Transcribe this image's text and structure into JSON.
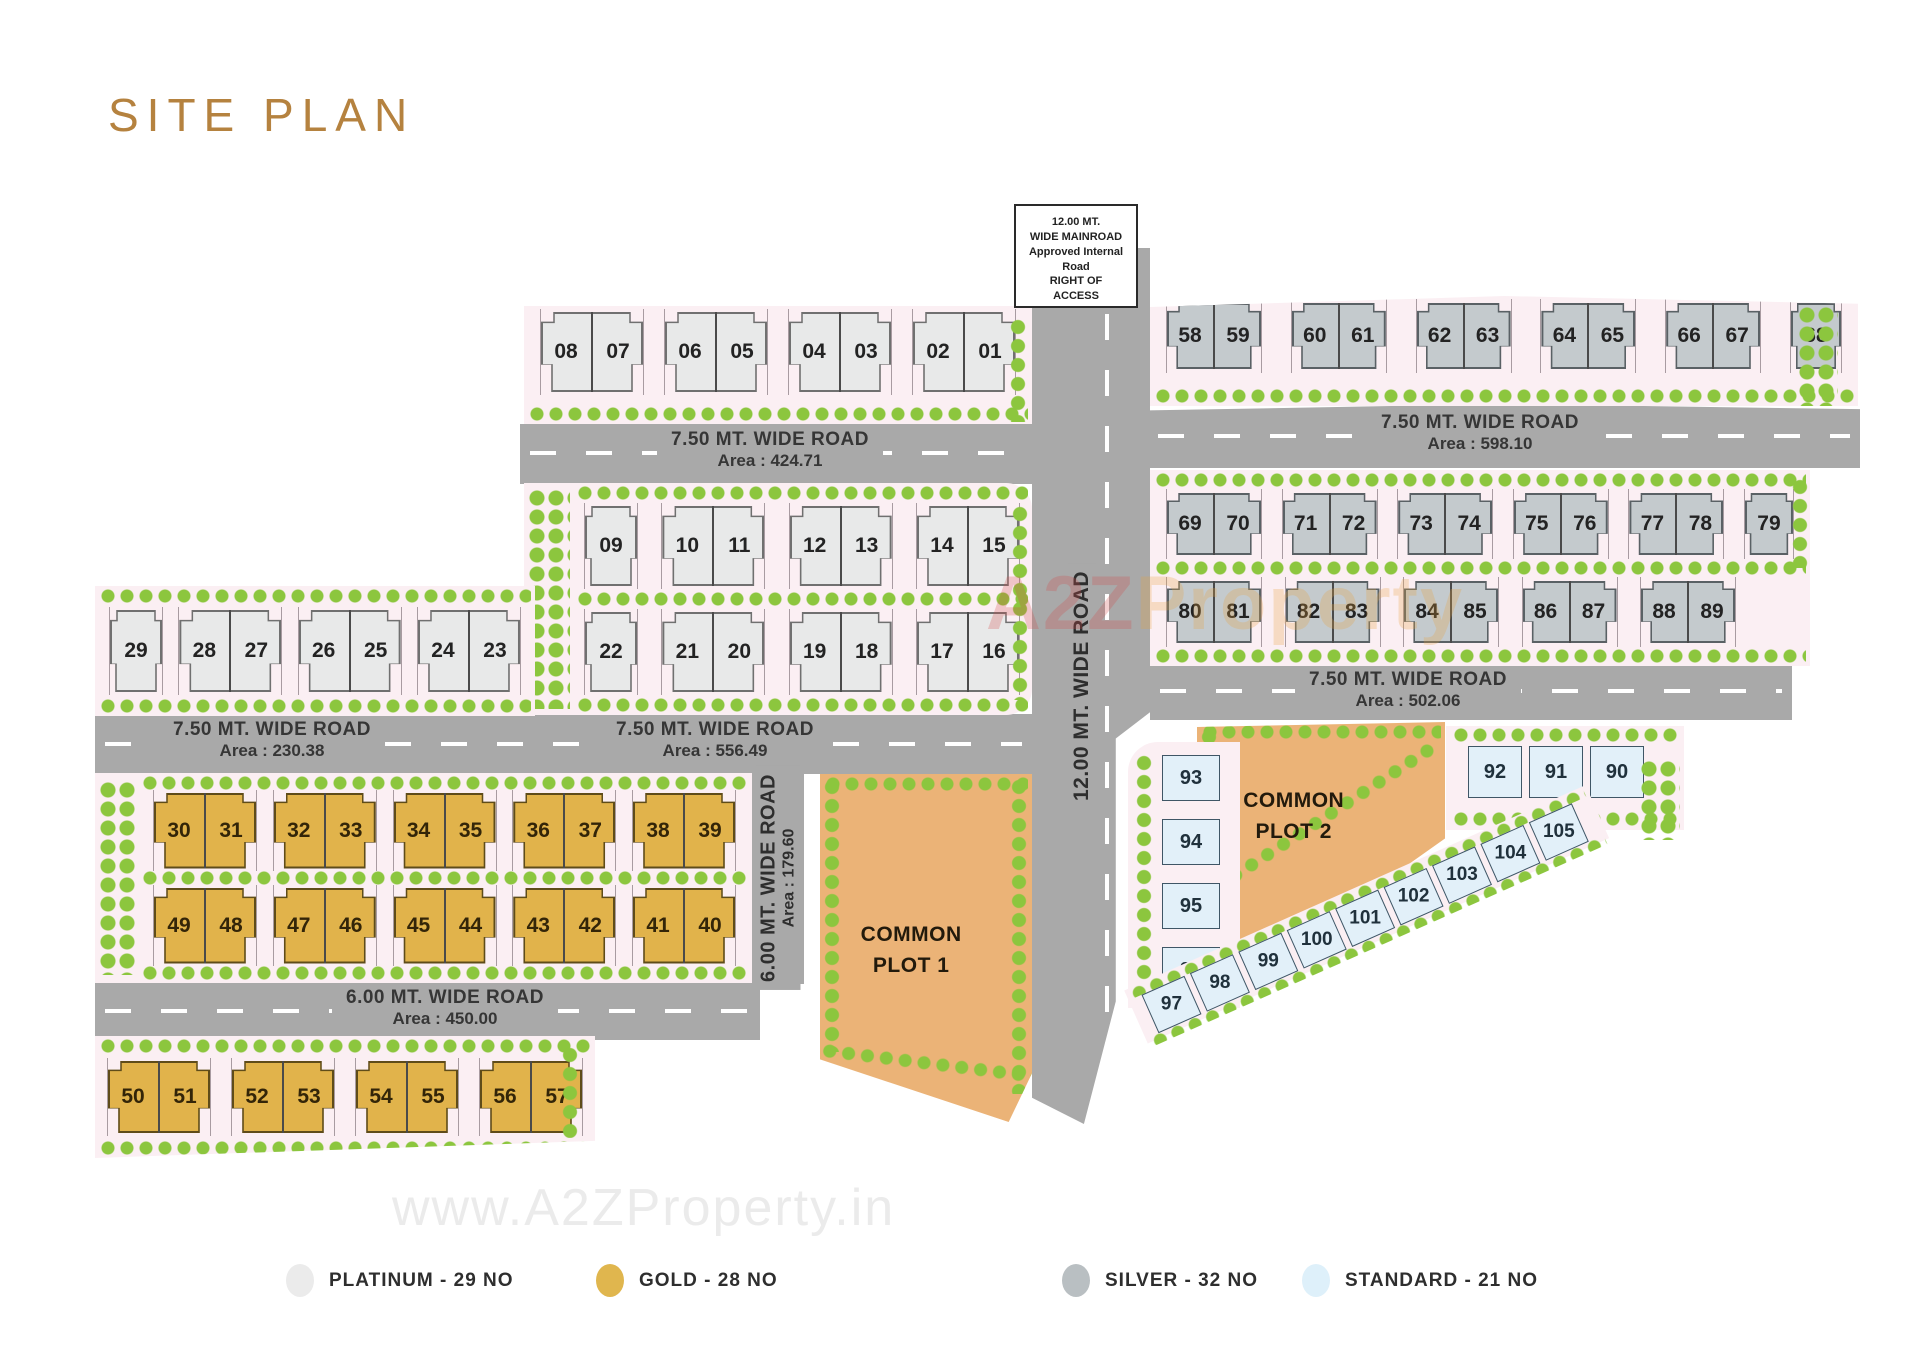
{
  "title": "SITE PLAN",
  "mainroad_box": "12.00 MT.\nWIDE MAINROAD\nApproved Internal\nRoad\nRIGHT OF\nACCESS",
  "roads": {
    "r424": {
      "name": "7.50 MT. WIDE ROAD",
      "area": "Area : 424.71"
    },
    "r598": {
      "name": "7.50 MT. WIDE ROAD",
      "area": "Area : 598.10"
    },
    "r230": {
      "name": "7.50 MT. WIDE ROAD",
      "area": "Area : 230.38"
    },
    "r556": {
      "name": "7.50 MT. WIDE ROAD",
      "area": "Area : 556.49"
    },
    "r502": {
      "name": "7.50 MT. WIDE ROAD",
      "area": "Area : 502.06"
    },
    "r450": {
      "name": "6.00 MT. WIDE ROAD",
      "area": "Area : 450.00"
    },
    "r179": {
      "name": "6.00 MT. WIDE ROAD",
      "area": "Area : 179.60"
    },
    "r12": {
      "name": "12.00 MT. WIDE ROAD"
    }
  },
  "common_plots": {
    "plot1": "COMMON\nPLOT 1",
    "plot2": "COMMON\nPLOT 2"
  },
  "clusters": {
    "platinum_top": [
      [
        "08",
        "07"
      ],
      [
        "06",
        "05"
      ],
      [
        "04",
        "03"
      ],
      [
        "02",
        "01"
      ]
    ],
    "silver_top": [
      [
        "58",
        "59"
      ],
      [
        "60",
        "61"
      ],
      [
        "62",
        "63"
      ],
      [
        "64",
        "65"
      ],
      [
        "66",
        "67"
      ],
      [
        "68"
      ]
    ],
    "platinum_mid_r1": [
      [
        "09"
      ],
      [
        "10",
        "11"
      ],
      [
        "12",
        "13"
      ],
      [
        "14",
        "15"
      ]
    ],
    "platinum_mid_r2": [
      [
        "22"
      ],
      [
        "21",
        "20"
      ],
      [
        "19",
        "18"
      ],
      [
        "17",
        "16"
      ]
    ],
    "silver_mid_r1": [
      [
        "69",
        "70"
      ],
      [
        "71",
        "72"
      ],
      [
        "73",
        "74"
      ],
      [
        "75",
        "76"
      ],
      [
        "77",
        "78"
      ],
      [
        "79"
      ]
    ],
    "silver_mid_r2": [
      [
        "80",
        "81"
      ],
      [
        "82",
        "83"
      ],
      [
        "84",
        "85"
      ],
      [
        "86",
        "87"
      ],
      [
        "88",
        "89"
      ]
    ],
    "platinum_left": [
      [
        "29"
      ],
      [
        "28",
        "27"
      ],
      [
        "26",
        "25"
      ],
      [
        "24",
        "23"
      ]
    ],
    "gold_r1": [
      [
        "30",
        "31"
      ],
      [
        "32",
        "33"
      ],
      [
        "34",
        "35"
      ],
      [
        "36",
        "37"
      ],
      [
        "38",
        "39"
      ]
    ],
    "gold_r2": [
      [
        "49",
        "48"
      ],
      [
        "47",
        "46"
      ],
      [
        "45",
        "44"
      ],
      [
        "43",
        "42"
      ],
      [
        "41",
        "40"
      ]
    ],
    "gold_bottom": [
      [
        "50",
        "51"
      ],
      [
        "52",
        "53"
      ],
      [
        "54",
        "55"
      ],
      [
        "56",
        "57"
      ]
    ],
    "standard_col": [
      [
        "93"
      ],
      [
        "94"
      ],
      [
        "95"
      ],
      [
        "96"
      ]
    ],
    "standard_top": [
      [
        "92"
      ],
      [
        "91"
      ],
      [
        "90"
      ]
    ],
    "standard_diag": [
      [
        "97"
      ],
      [
        "98"
      ],
      [
        "99"
      ],
      [
        "100"
      ],
      [
        "101"
      ],
      [
        "102"
      ],
      [
        "103"
      ],
      [
        "104"
      ],
      [
        "105"
      ]
    ]
  },
  "legend": [
    {
      "label": "PLATINUM - 29 NO",
      "color": "#ebebeb"
    },
    {
      "label": "GOLD - 28 NO",
      "color": "#e0b64e"
    },
    {
      "label": "SILVER - 32 NO",
      "color": "#b9bfc2"
    },
    {
      "label": "STANDARD - 21 NO",
      "color": "#def0fa"
    }
  ],
  "watermarks": {
    "center_a2z": "A2Z",
    "center_property": "Property",
    "bottom": "www.A2ZProperty.in"
  }
}
